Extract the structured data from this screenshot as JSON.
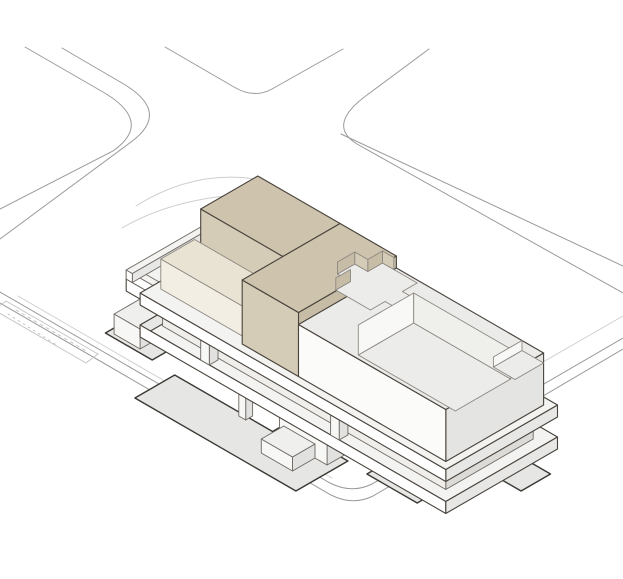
{
  "figure": {
    "kind": "architectural-axonometric-site-diagram",
    "background": "#ffffff",
    "width": 623,
    "height": 579
  },
  "colors": {
    "site_line": "#9a9a9a",
    "faint_line": "#cdcdcb",
    "dash_line": "#c2c2c0",
    "shadow_fill": "#e6e6e4",
    "shadow_stroke": "#3b3834",
    "inner_stroke": "#8d8781",
    "volume_stroke": "#49433c",
    "detail_stroke": "#6e6862",
    "tan": {
      "top": "#cec4ae",
      "sw": "#d5ccb7",
      "se": "#c7bda6"
    },
    "terr": {
      "top": "#e9e3d4",
      "sw": "#f2eee3",
      "se": "#d9d0bb"
    },
    "white": {
      "top": "#ebebe9",
      "sw": "#fbfbfa",
      "se": "#e4e4e2"
    },
    "band": {
      "top": "#f3f3f1",
      "sw": "#ffffff",
      "se": "#e7e7e5"
    },
    "core": {
      "top": "#efefed",
      "sw": "#f7f7f6",
      "se": "#e1e1df"
    },
    "recess": {
      "top": "#e8e7e4",
      "sw": "#efeeea",
      "se": "#dcdbd7"
    },
    "cut": {
      "floor": "#ececea",
      "bright": "#f8f8f6",
      "mid": "#efefec"
    }
  },
  "scene": {
    "origin": {
      "x": 121,
      "y": 344
    },
    "items": [
      {
        "kind": "path",
        "name": "street-corner-left-outer",
        "d": "M 25,47 L 103,92 Q 154,122 113,151 L 0,209",
        "stroke": "site_line",
        "w": 1
      },
      {
        "kind": "path",
        "name": "street-corner-left-inner",
        "d": "M 62,48 L 122,83 Q 172,112 131,142 L 0,239",
        "stroke": "site_line",
        "w": 1
      },
      {
        "kind": "path",
        "name": "street-corner-north",
        "d": "M 165,47 L 234,87 Q 254,99 272,89 L 343,49",
        "stroke": "site_line",
        "w": 1
      },
      {
        "kind": "path",
        "name": "street-corner-right-curve",
        "d": "M 429,49 L 367,95 Q 326,125 357,144 L 623,293",
        "stroke": "site_line",
        "w": 1
      },
      {
        "kind": "path",
        "name": "street-corner-right-curb",
        "d": "M 341,134 L 623,266",
        "stroke": "site_line",
        "w": 1
      },
      {
        "kind": "path",
        "name": "plaza-boundary-inner",
        "d": "M 0,292 L 330,483 Q 352,494 372,484 L 623,338",
        "stroke": "site_line",
        "w": 1
      },
      {
        "kind": "path",
        "name": "plaza-boundary-outer",
        "d": "M 0,303 L 331,495 Q 353,506 373,496 L 623,349",
        "stroke": "site_line",
        "w": 1
      },
      {
        "kind": "path",
        "name": "sidewalk-right-curb",
        "d": "M 623,316 L 430,427",
        "stroke": "faint_line",
        "w": 0.9
      },
      {
        "kind": "path",
        "name": "plaza-faint-edge",
        "d": "M 18,296 L 332,478",
        "stroke": "faint_line",
        "w": 0.9
      },
      {
        "kind": "path",
        "name": "path-curve-northwest-1",
        "d": "M 136,206 Q 196,168 262,180",
        "stroke": "faint_line",
        "w": 0.9
      },
      {
        "kind": "path",
        "name": "path-curve-northwest-2",
        "d": "M 122,228 Q 175,197 252,194",
        "stroke": "faint_line",
        "w": 0.9
      },
      {
        "kind": "path",
        "name": "parking-strip-outline",
        "d": "M 6,301 L 98,354 L 86,363 L -6,310 Z",
        "stroke": "dash_line",
        "w": 0.9
      },
      {
        "kind": "path",
        "name": "parking-strip-hatch-1",
        "d": "M 16,310 L 88,352",
        "stroke": "dash_line",
        "w": 0.9,
        "dash": "3 4"
      },
      {
        "kind": "path",
        "name": "parking-strip-hatch-2",
        "d": "M 8,314 L 58,346",
        "stroke": "dash_line",
        "w": 0.9,
        "dash": "2 4"
      },
      {
        "kind": "plan",
        "name": "ground-shadow-deck",
        "w": 0,
        "fill": "shadow_fill",
        "stroke": "shadow_stroke",
        "sw": 1.4,
        "pts": [
          [
            2,
            -20
          ],
          [
            38,
            -20
          ],
          [
            38,
            34
          ],
          [
            2,
            34
          ]
        ]
      },
      {
        "kind": "plan",
        "name": "ground-shadow-main",
        "w": 0,
        "fill": "shadow_fill",
        "stroke": "shadow_stroke",
        "sw": 1.4,
        "pts": [
          [
            -46,
            62
          ],
          [
            0,
            62
          ],
          [
            0,
            175
          ],
          [
            14,
            175
          ],
          [
            14,
            248
          ],
          [
            -46,
            248
          ]
        ]
      },
      {
        "kind": "plan",
        "name": "ground-shadow-right",
        "w": 0,
        "fill": "shadow_fill",
        "stroke": "shadow_stroke",
        "sw": 1.4,
        "pts": [
          [
            12,
            272
          ],
          [
            56,
            272
          ],
          [
            56,
            330
          ],
          [
            12,
            330
          ]
        ]
      },
      {
        "kind": "plan",
        "name": "ground-shadow-east",
        "w": 0,
        "fill": "shadow_fill",
        "stroke": "shadow_stroke",
        "sw": 1.4,
        "pts": [
          [
            84,
            330
          ],
          [
            118,
            330
          ],
          [
            118,
            378
          ],
          [
            84,
            378
          ]
        ]
      },
      {
        "kind": "box",
        "name": "ground-core-west",
        "u": [
          6,
          36
        ],
        "v": [
          -14,
          16
        ],
        "h": [
          0,
          20
        ],
        "pal": "core",
        "stroke": "detail_stroke",
        "sw": 0.9
      },
      {
        "kind": "box",
        "name": "ground-core-a",
        "u": [
          30,
          72
        ],
        "v": [
          70,
          120
        ],
        "h": [
          0,
          26
        ],
        "pal": "core",
        "stroke": "detail_stroke",
        "sw": 0.9
      },
      {
        "kind": "box",
        "name": "ground-core-b",
        "u": [
          -2,
          42
        ],
        "v": [
          185,
          240
        ],
        "h": [
          0,
          26
        ],
        "pal": "core",
        "stroke": "detail_stroke",
        "sw": 0.9
      },
      {
        "kind": "box",
        "name": "ground-core-c",
        "u": [
          30,
          72
        ],
        "v": [
          270,
          315
        ],
        "h": [
          0,
          26
        ],
        "pal": "core",
        "stroke": "detail_stroke",
        "sw": 0.9
      },
      {
        "kind": "box",
        "name": "ground-column",
        "u": [
          -4,
          4
        ],
        "v": [
          140,
          148
        ],
        "h": [
          0,
          26
        ],
        "pal": "core",
        "stroke": "detail_stroke",
        "sw": 0.9
      },
      {
        "kind": "box",
        "name": "entry-stair-box",
        "u": [
          -28,
          -2
        ],
        "v": [
          190,
          226
        ],
        "h": [
          0,
          14
        ],
        "pal": "core",
        "stroke": "detail_stroke",
        "sw": 0.9
      },
      {
        "kind": "plan",
        "name": "slab-band-1-top",
        "w": 38,
        "fill": "band.top",
        "stroke": "volume_stroke",
        "sw": 1.1,
        "pts": [
          [
            121,
            -24
          ],
          [
            30,
            -24
          ],
          [
            30,
            30
          ],
          [
            -8,
            30
          ],
          [
            -8,
            383
          ],
          [
            121,
            383
          ]
        ]
      },
      {
        "kind": "face",
        "name": "slab-band-1-end-face",
        "fill": "band.se",
        "stroke": "volume_stroke",
        "sw": 1.1,
        "pts3": [
          [
            -8,
            30,
            26
          ],
          [
            30,
            30,
            26
          ],
          [
            30,
            30,
            38
          ],
          [
            -8,
            30,
            38
          ]
        ]
      },
      {
        "kind": "face",
        "name": "slab-band-1-deck-fascia",
        "fill": "band.sw",
        "stroke": "volume_stroke",
        "sw": 1.1,
        "pts3": [
          [
            30,
            -24,
            26
          ],
          [
            30,
            30,
            26
          ],
          [
            30,
            30,
            38
          ],
          [
            30,
            -24,
            38
          ]
        ]
      },
      {
        "kind": "face",
        "name": "slab-band-1-front-fascia",
        "fill": "band.sw",
        "stroke": "volume_stroke",
        "sw": 1.1,
        "pts3": [
          [
            -8,
            30,
            26
          ],
          [
            -8,
            383,
            26
          ],
          [
            -8,
            383,
            38
          ],
          [
            -8,
            30,
            38
          ]
        ]
      },
      {
        "kind": "face",
        "name": "slab-band-1-se-fascia",
        "fill": "band.se",
        "stroke": "volume_stroke",
        "sw": 1.1,
        "pts3": [
          [
            -8,
            383,
            26
          ],
          [
            121,
            383,
            26
          ],
          [
            121,
            383,
            38
          ],
          [
            -8,
            383,
            38
          ]
        ]
      },
      {
        "kind": "box",
        "name": "deck-parapet-sw",
        "u": [
          30,
          37
        ],
        "v": [
          -24,
          36
        ],
        "h": [
          38,
          47
        ],
        "pal": "band",
        "stroke": "detail_stroke",
        "sw": 0.9
      },
      {
        "kind": "box",
        "name": "deck-parapet-nw",
        "u": [
          30,
          121
        ],
        "v": [
          -24,
          -17
        ],
        "h": [
          38,
          47
        ],
        "pal": "band",
        "stroke": "detail_stroke",
        "sw": 0.9
      },
      {
        "kind": "box",
        "name": "recessed-floor-glazing",
        "u": [
          4,
          105
        ],
        "v": [
          44,
          371
        ],
        "h": [
          38,
          58
        ],
        "pal": "recess",
        "stroke": "detail_stroke",
        "sw": 0.9
      },
      {
        "kind": "box",
        "name": "pilotis-column-1",
        "u": [
          -8,
          2
        ],
        "v": [
          100,
          110
        ],
        "h": [
          38,
          58
        ],
        "pal": "core",
        "stroke": "detail_stroke",
        "sw": 0.9
      },
      {
        "kind": "box",
        "name": "pilotis-column-2",
        "u": [
          -8,
          2
        ],
        "v": [
          250,
          260
        ],
        "h": [
          38,
          58
        ],
        "pal": "core",
        "stroke": "detail_stroke",
        "sw": 0.9
      },
      {
        "kind": "box",
        "name": "pilotis-column-3",
        "u": [
          40,
          50
        ],
        "v": [
          30,
          40
        ],
        "h": [
          38,
          58
        ],
        "pal": "core",
        "stroke": "detail_stroke",
        "sw": 0.9
      },
      {
        "kind": "box",
        "name": "pilotis-column-4",
        "u": [
          85,
          95
        ],
        "v": [
          30,
          40
        ],
        "h": [
          38,
          58
        ],
        "pal": "core",
        "stroke": "detail_stroke",
        "sw": 0.9
      },
      {
        "kind": "box",
        "name": "slab-band-2",
        "u": [
          -8,
          121
        ],
        "v": [
          30,
          383
        ],
        "h": [
          58,
          70
        ],
        "pal": "band",
        "stroke": "volume_stroke",
        "sw": 1.1
      },
      {
        "kind": "box",
        "name": "tan-volume-northwest",
        "u": [
          47,
          113
        ],
        "v": [
          45,
          140
        ],
        "h": [
          70,
          134
        ],
        "pal": "tan",
        "stroke": "volume_stroke",
        "sw": 1.1
      },
      {
        "kind": "box",
        "name": "tan-terrace-step",
        "u": [
          8,
          47
        ],
        "v": [
          38,
          140
        ],
        "h": [
          70,
          100
        ],
        "pal": "terr",
        "stroke": "inner_stroke",
        "sw": 0.9
      },
      {
        "kind": "box",
        "name": "tan-volume-main",
        "u": [
          0,
          113
        ],
        "v": [
          140,
          205
        ],
        "h": [
          70,
          134
        ],
        "pal": "tan",
        "stroke": "volume_stroke",
        "sw": 1.1
      },
      {
        "kind": "box",
        "name": "white-volume-southeast",
        "u": [
          0,
          113
        ],
        "v": [
          205,
          375
        ],
        "h": [
          70,
          122
        ],
        "pal": "white",
        "stroke": "volume_stroke",
        "sw": 1.1
      },
      {
        "kind": "plan",
        "name": "roof-cross-cutout",
        "w": 122,
        "fill": "cut.floor",
        "stroke": "inner_stroke",
        "sw": 0.9,
        "pts": [
          [
            56,
            192
          ],
          [
            73,
            192
          ],
          [
            73,
            177
          ],
          [
            93,
            177
          ],
          [
            93,
            192
          ],
          [
            110,
            192
          ],
          [
            110,
            232
          ],
          [
            93,
            232
          ],
          [
            93,
            247
          ],
          [
            73,
            247
          ],
          [
            73,
            232
          ],
          [
            56,
            232
          ]
        ]
      },
      {
        "kind": "face",
        "name": "cross-step-face-1",
        "fill": "tan.se",
        "stroke": "inner_stroke",
        "sw": 0.9,
        "pts3": [
          [
            73,
            177,
            122
          ],
          [
            93,
            177,
            122
          ],
          [
            93,
            177,
            134
          ],
          [
            73,
            177,
            134
          ]
        ]
      },
      {
        "kind": "face",
        "name": "cross-step-face-2",
        "fill": "tan.se",
        "stroke": "inner_stroke",
        "sw": 0.9,
        "pts3": [
          [
            56,
            192,
            122
          ],
          [
            73,
            192,
            122
          ],
          [
            73,
            192,
            134
          ],
          [
            56,
            192,
            134
          ]
        ]
      },
      {
        "kind": "face",
        "name": "cross-step-face-3",
        "fill": "tan.se",
        "stroke": "inner_stroke",
        "sw": 0.9,
        "pts3": [
          [
            93,
            192,
            122
          ],
          [
            110,
            192,
            122
          ],
          [
            110,
            192,
            134
          ],
          [
            93,
            192,
            134
          ]
        ]
      },
      {
        "kind": "face",
        "name": "cross-step-face-4",
        "fill": "tan.sw",
        "stroke": "inner_stroke",
        "sw": 0.9,
        "pts3": [
          [
            110,
            192,
            122
          ],
          [
            110,
            205,
            122
          ],
          [
            110,
            205,
            134
          ],
          [
            110,
            192,
            134
          ]
        ]
      },
      {
        "kind": "face",
        "name": "cross-step-face-5",
        "fill": "tan.sw",
        "stroke": "inner_stroke",
        "sw": 0.9,
        "pts3": [
          [
            93,
            177,
            122
          ],
          [
            93,
            192,
            122
          ],
          [
            93,
            192,
            134
          ],
          [
            93,
            177,
            134
          ]
        ]
      },
      {
        "kind": "face",
        "name": "courtyard-floor",
        "fill": "cut.floor",
        "stroke": "inner_stroke",
        "sw": 0.9,
        "pts3": [
          [
            34,
            240,
            92
          ],
          [
            98,
            240,
            92
          ],
          [
            98,
            352,
            92
          ],
          [
            34,
            352,
            92
          ]
        ]
      },
      {
        "kind": "face",
        "name": "courtyard-wall-northwest",
        "fill": "cut.bright",
        "stroke": "inner_stroke",
        "sw": 0.9,
        "pts3": [
          [
            34,
            240,
            92
          ],
          [
            98,
            240,
            92
          ],
          [
            98,
            240,
            122
          ],
          [
            34,
            240,
            122
          ]
        ]
      },
      {
        "kind": "face",
        "name": "courtyard-wall-back",
        "fill": "cut.mid",
        "stroke": "inner_stroke",
        "sw": 0.9,
        "pts3": [
          [
            98,
            240,
            92
          ],
          [
            98,
            352,
            92
          ],
          [
            98,
            352,
            122
          ],
          [
            98,
            240,
            122
          ]
        ]
      },
      {
        "kind": "face",
        "name": "east-notch-floor",
        "fill": "cut.floor",
        "stroke": "inner_stroke",
        "sw": 0.9,
        "pts3": [
          [
            80,
            350,
            112
          ],
          [
            113,
            350,
            112
          ],
          [
            113,
            375,
            112
          ],
          [
            80,
            375,
            112
          ]
        ]
      },
      {
        "kind": "face",
        "name": "east-notch-wall",
        "fill": "cut.bright",
        "stroke": "inner_stroke",
        "sw": 0.9,
        "pts3": [
          [
            80,
            350,
            112
          ],
          [
            113,
            350,
            112
          ],
          [
            113,
            350,
            122
          ],
          [
            80,
            350,
            122
          ]
        ]
      }
    ]
  }
}
